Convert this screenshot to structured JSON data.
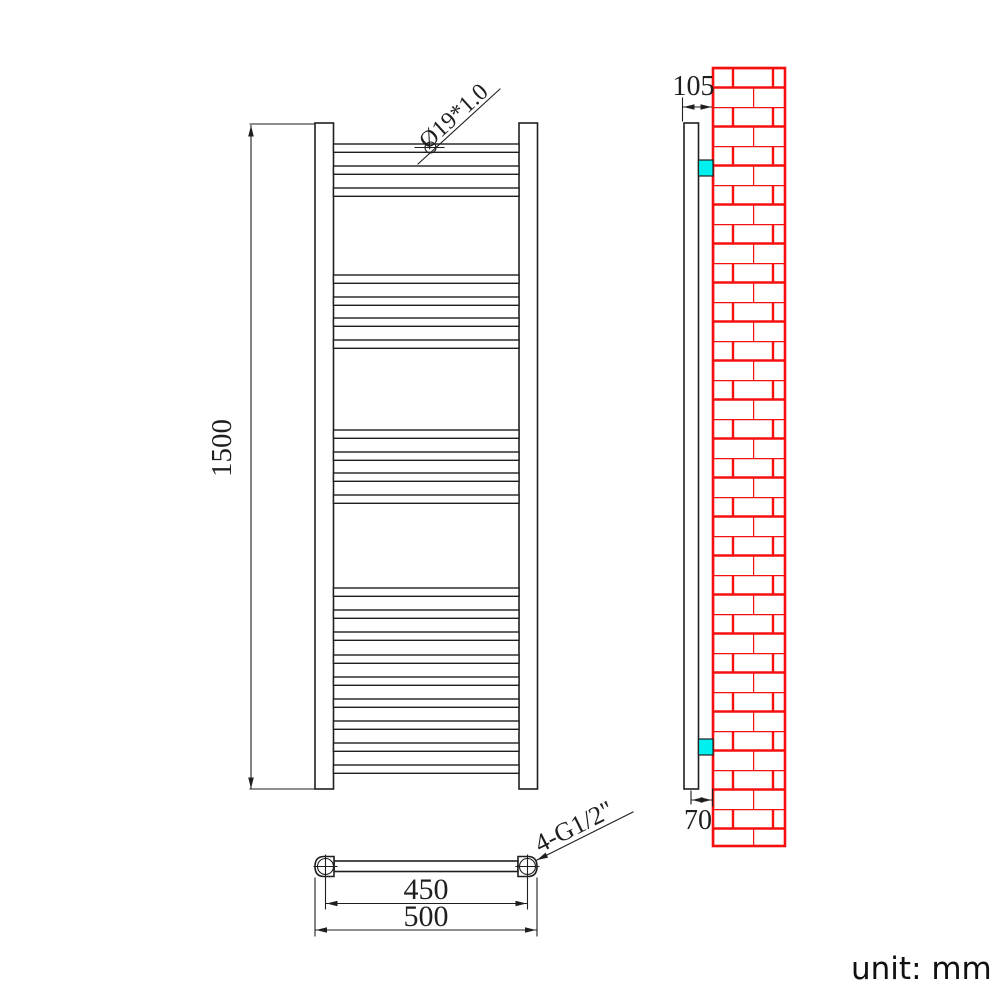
{
  "unit_label": "unit: mm",
  "colors": {
    "line": "#1f1f1f",
    "brick": "#f50f0f",
    "bracket": "#00f0f0"
  },
  "front_view": {
    "height_dim": "1500",
    "tube_spec": "Ø19*1.0",
    "bar_groups": [
      [
        144,
        166,
        188
      ],
      [
        275,
        297,
        318,
        340
      ],
      [
        430,
        452,
        473,
        495
      ],
      [
        588,
        610,
        632,
        655,
        677,
        699,
        721,
        743,
        765
      ]
    ]
  },
  "top_view": {
    "center_dim": "450",
    "overall_dim": "500",
    "connection_spec": "4-G1/2\""
  },
  "side_view": {
    "depth_dim": "105",
    "offset_dim": "70"
  }
}
